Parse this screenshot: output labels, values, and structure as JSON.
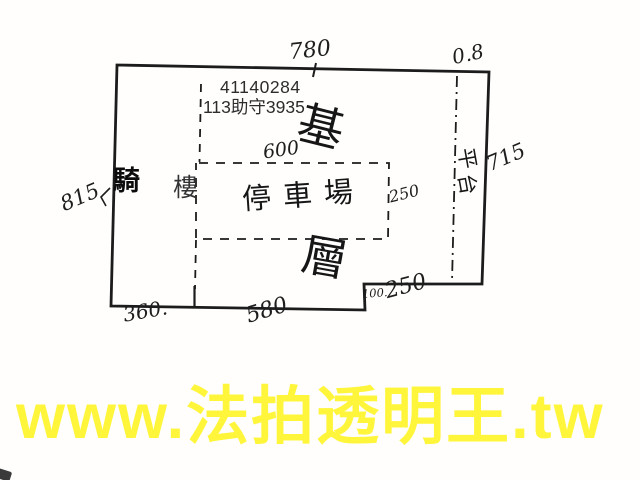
{
  "watermark": {
    "text": "www.法拍透明王.tw",
    "color": "#FFF53A"
  },
  "stamp": {
    "case_number": "41140284",
    "case_reference": "113助守3935"
  },
  "plan": {
    "line_color": "#1c1c1c",
    "floor_label": {
      "top_char": "基",
      "bottom_char": "層"
    },
    "rooms": {
      "arcade_char1": "騎",
      "arcade_char2": "樓",
      "parking": "停車場",
      "platform_char1": "平",
      "platform_char2": "台"
    },
    "dimensions": {
      "top_width": "780",
      "top_right": "0.8",
      "left_height": "815",
      "right_height": "715",
      "parking_width": "600",
      "parking_depth": "250",
      "bottom_left": "360.",
      "bottom_center": "580",
      "notch_height": "100.",
      "notch_width": "250"
    }
  }
}
